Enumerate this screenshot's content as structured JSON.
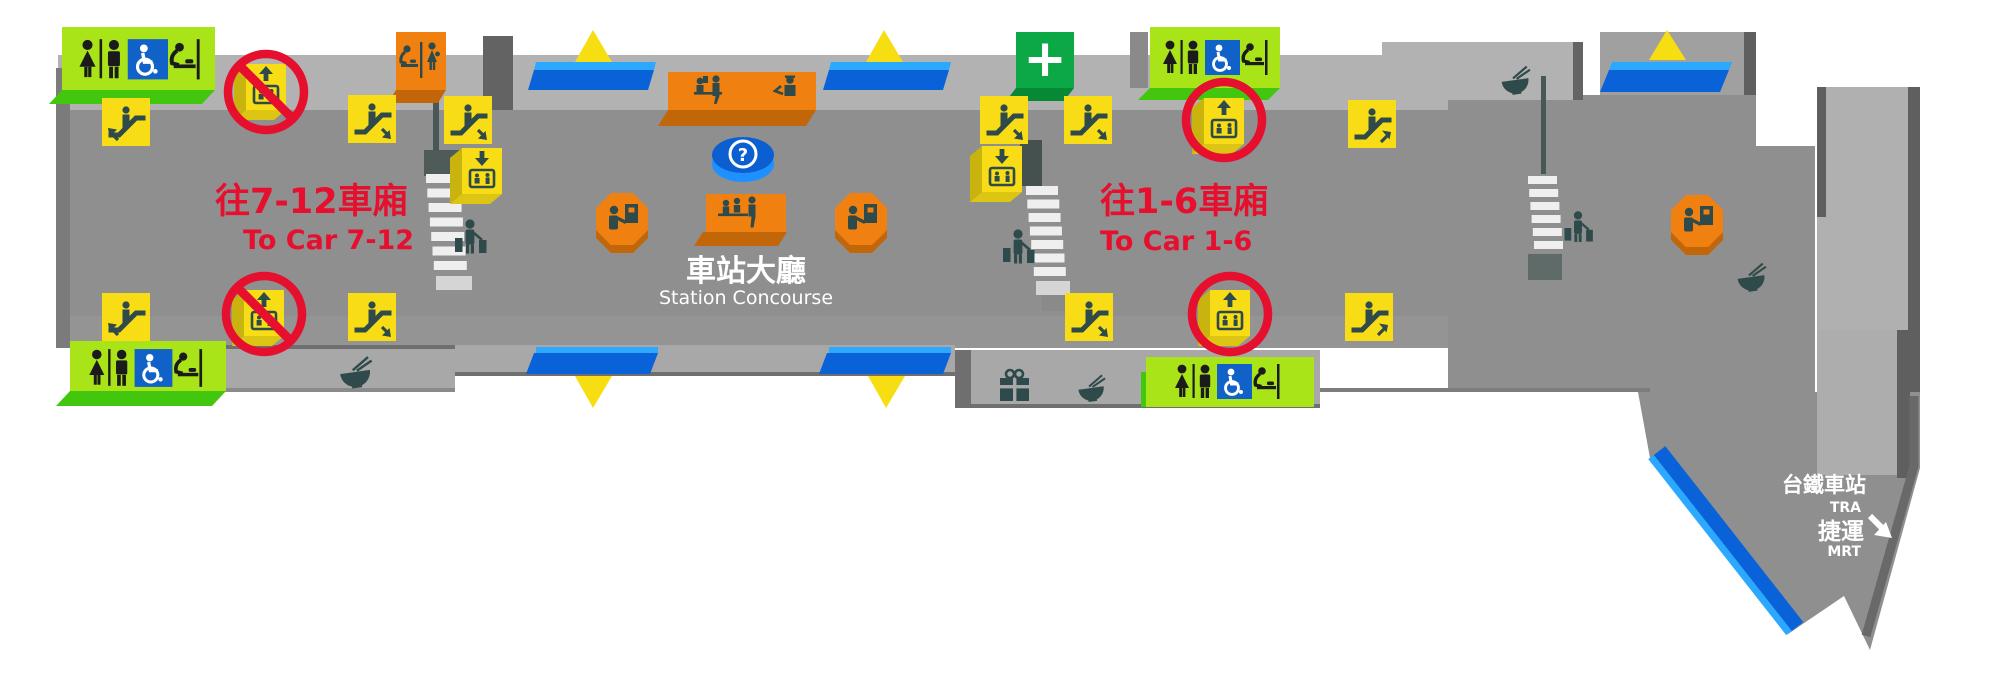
{
  "map": {
    "labels": {
      "to_car_7_12_zh": "往7-12車廂",
      "to_car_7_12_en": "To Car 7-12",
      "to_car_1_6_zh": "往1-6車廂",
      "to_car_1_6_en": "To Car 1-6",
      "concourse_zh": "車站大廳",
      "concourse_en": "Station Concourse",
      "tra_zh": "台鐵車站",
      "tra_en": "TRA",
      "mrt_zh": "捷運",
      "mrt_en": "MRT"
    },
    "symbols": {
      "information": "?",
      "first_aid": "+"
    },
    "colors": {
      "floor": "#8f8f8f",
      "wall_band": "#b2b2b2",
      "shelf": "#a8a8a8",
      "highlight_red": "#e60f2e",
      "facility_yellow": "#f7dc16",
      "restroom_green": "#a9e418",
      "restroom_green_bevel": "#42c70e",
      "accessible_blue": "#1062c8",
      "service_orange": "#f08010",
      "service_orange_bevel": "#c2660a",
      "first_aid_green": "#0ca845",
      "gate_blue": "#0a62d8",
      "gate_blue_light": "#2ca9ff",
      "icon_teal": "#2f4a4a"
    }
  }
}
